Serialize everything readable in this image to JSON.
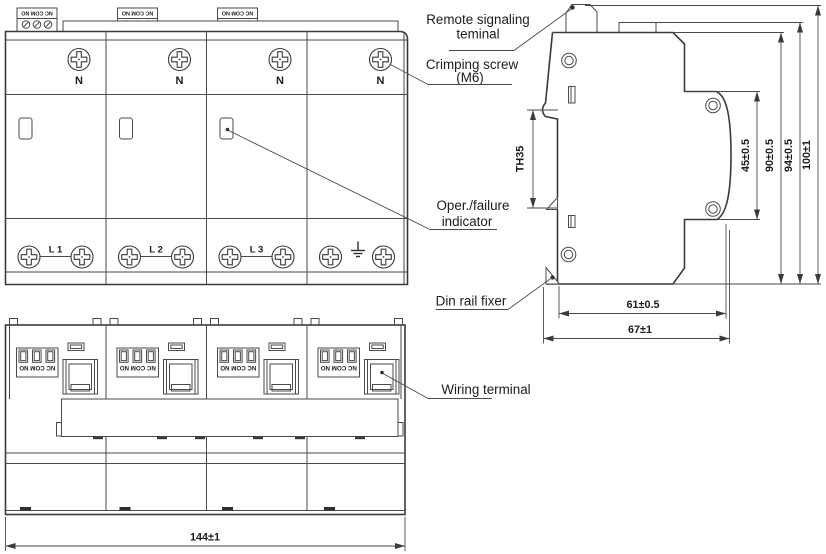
{
  "drawing": {
    "annotations": {
      "remote_signaling_line1": "Remote signaling",
      "remote_signaling_line2": "teminal",
      "crimping_line1": "Crimping screw",
      "crimping_line2": "(M6)",
      "oper_line1": "Oper./failure",
      "oper_line2": "indicator",
      "din_rail": "Din rail fixer",
      "wiring": "Wiring terminal"
    },
    "front_view": {
      "n_labels": [
        "N",
        "N",
        "N",
        "N"
      ],
      "phase_labels": [
        "L 1",
        "L 2",
        "L 3"
      ],
      "terminal_text": "NC COM NO"
    },
    "side_view": {
      "rail_label": "TH35",
      "dim_45": "45±0.5",
      "dim_90": "90±0.5",
      "dim_94": "94±0.5",
      "dim_100": "100±1",
      "dim_61": "61±0.5",
      "dim_67": "67±1"
    },
    "bottom_view": {
      "terminal_text": "NC COM NO",
      "dim_144": "144±1"
    }
  }
}
